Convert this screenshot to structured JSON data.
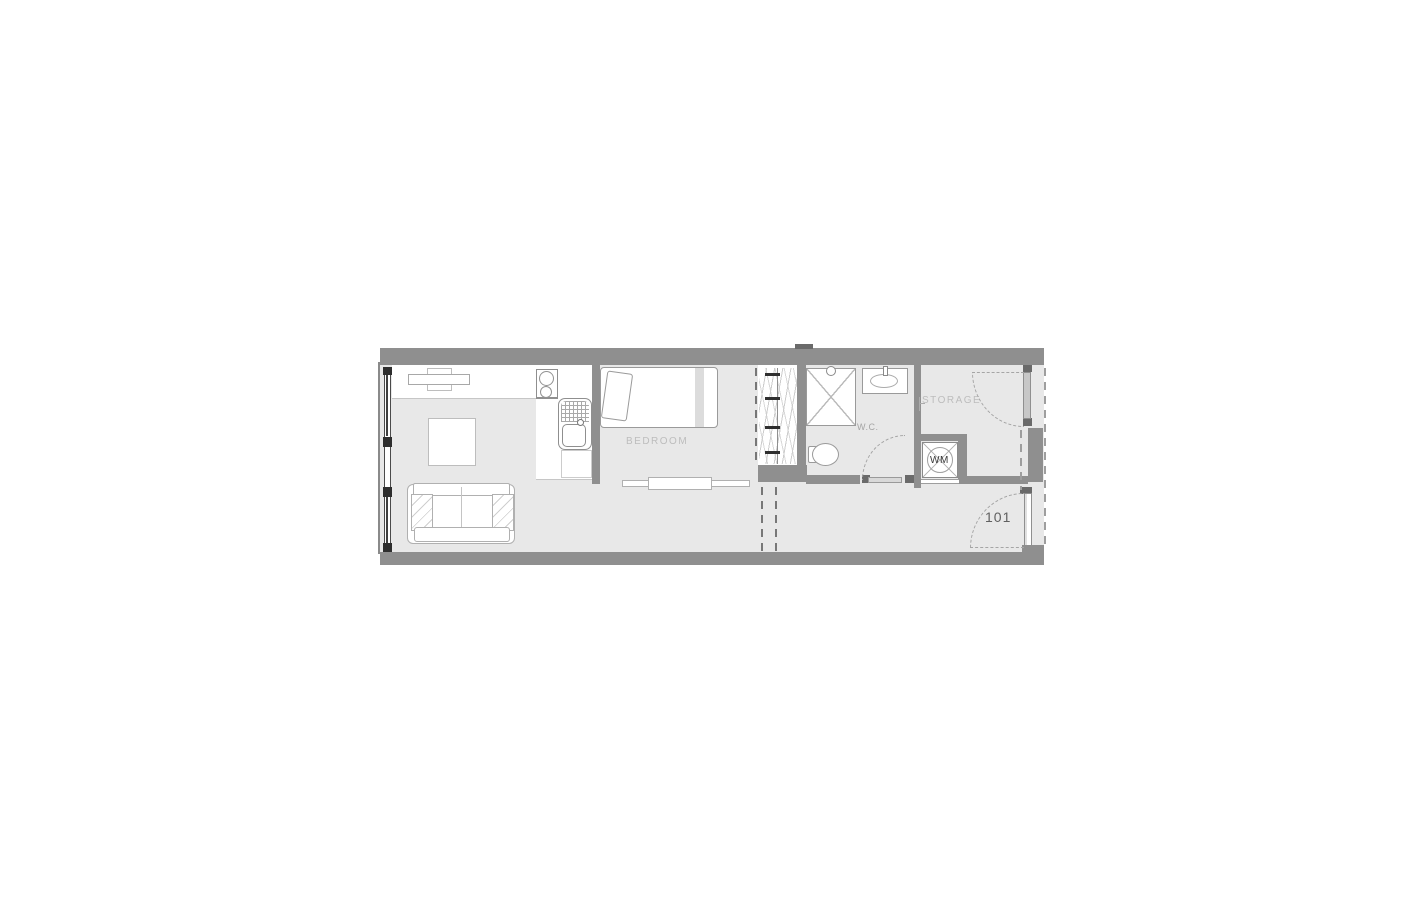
{
  "title": "Apartment unit floor plan",
  "unit": {
    "number": "101"
  },
  "labels": {
    "bedroom": "BEDROOM",
    "wc": "W.C.",
    "storage": "STORAGE",
    "washing_machine": "WM"
  },
  "colors": {
    "wall": "#8f8f8f",
    "wall_dark": "#6a6a6a",
    "floor": "#e8e8e8",
    "furniture_line": "#a8a8a8",
    "room_label": "#bdbdbd",
    "wc_label": "#a5a5a5",
    "unit_label": "#606060",
    "wm_label": "#383838",
    "glazing": "#3f3f3f"
  }
}
